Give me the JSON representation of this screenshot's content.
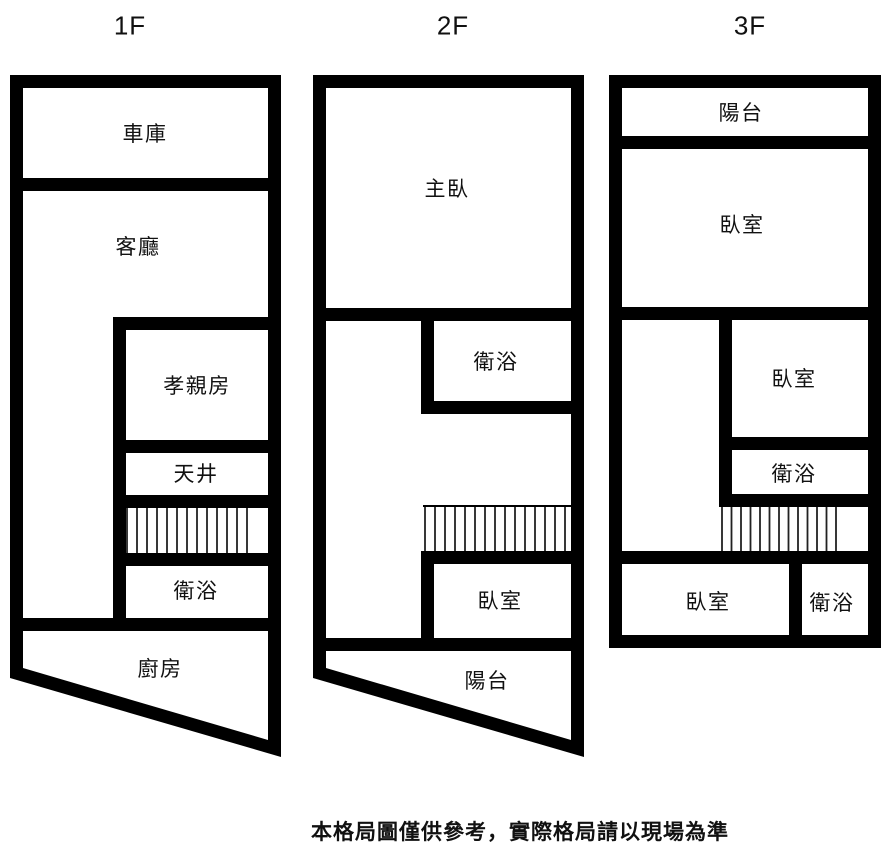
{
  "floors": [
    {
      "label": "1F",
      "rooms": [
        {
          "label": "車庫"
        },
        {
          "label": "客廳"
        },
        {
          "label": "孝親房"
        },
        {
          "label": "天井"
        },
        {
          "label": "衛浴"
        },
        {
          "label": "廚房"
        }
      ]
    },
    {
      "label": "2F",
      "rooms": [
        {
          "label": "主臥"
        },
        {
          "label": "衛浴"
        },
        {
          "label": "臥室"
        },
        {
          "label": "陽台"
        }
      ]
    },
    {
      "label": "3F",
      "rooms": [
        {
          "label": "陽台"
        },
        {
          "label": "臥室"
        },
        {
          "label": "臥室"
        },
        {
          "label": "衛浴"
        },
        {
          "label": "臥室"
        },
        {
          "label": "衛浴"
        }
      ]
    }
  ],
  "disclaimer": "本格局圖僅供參考，實際格局請以現場為準",
  "colors": {
    "wall": "#000000",
    "background": "#ffffff",
    "hatch": "#222222"
  }
}
